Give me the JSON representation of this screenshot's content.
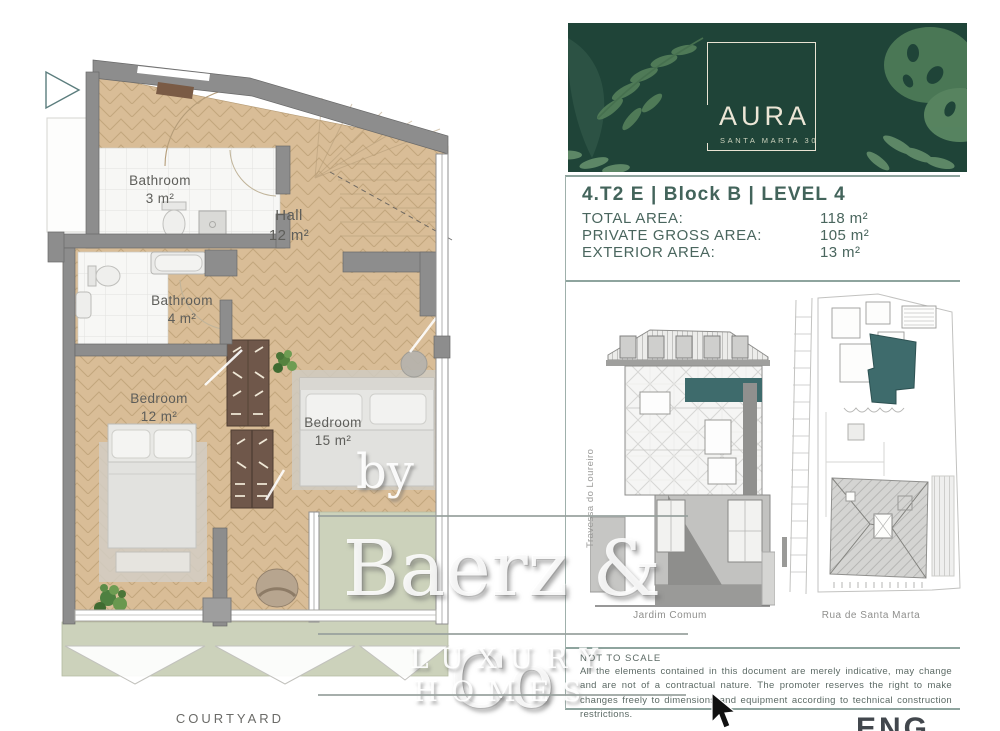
{
  "plan": {
    "rooms": [
      {
        "name": "Bathroom",
        "area": "3 m²"
      },
      {
        "name": "Hall",
        "area": "12 m²"
      },
      {
        "name": "Bathroom",
        "area": "4 m²"
      },
      {
        "name": "Bedroom",
        "area": "12 m²"
      },
      {
        "name": "Bedroom",
        "area": "15 m²"
      }
    ],
    "courtyard": "COURTYARD"
  },
  "watermark": {
    "by": "by",
    "brand": "Baerz & Co",
    "tagline": "LUXURY HOMES"
  },
  "panel": {
    "logo": {
      "title": "AURA",
      "subtitle": "SANTA MARTA 30"
    },
    "unit_title": "4.T2 E | Block B | LEVEL 4",
    "areas": [
      {
        "label": "TOTAL AREA:",
        "value": "118 m²"
      },
      {
        "label": "PRIVATE GROSS AREA:",
        "value": "105 m²"
      },
      {
        "label": "EXTERIOR AREA:",
        "value": "13 m²"
      }
    ],
    "elevation_street": "Travessa do Loureiro",
    "elevation_caption": "Jardim Comum",
    "siteplan_caption": "Rua de Santa Marta",
    "disclaimer_heading": "NOT TO SCALE",
    "disclaimer_body": "All the elements contained in this document are merely indicative, may change and are not of a contractual nature. The promoter reserves the right to make changes freely to dimensions and equipment according to technical construction restrictions.",
    "partial_logo": "ENG"
  },
  "colors": {
    "header_green": "#1f4438",
    "accent_teal": "#3e6b6c",
    "wood": "#d9bd97",
    "wall_gray": "#8d8d8d",
    "terrace_green": "#ccd2bb",
    "title_text": "#43645b"
  }
}
